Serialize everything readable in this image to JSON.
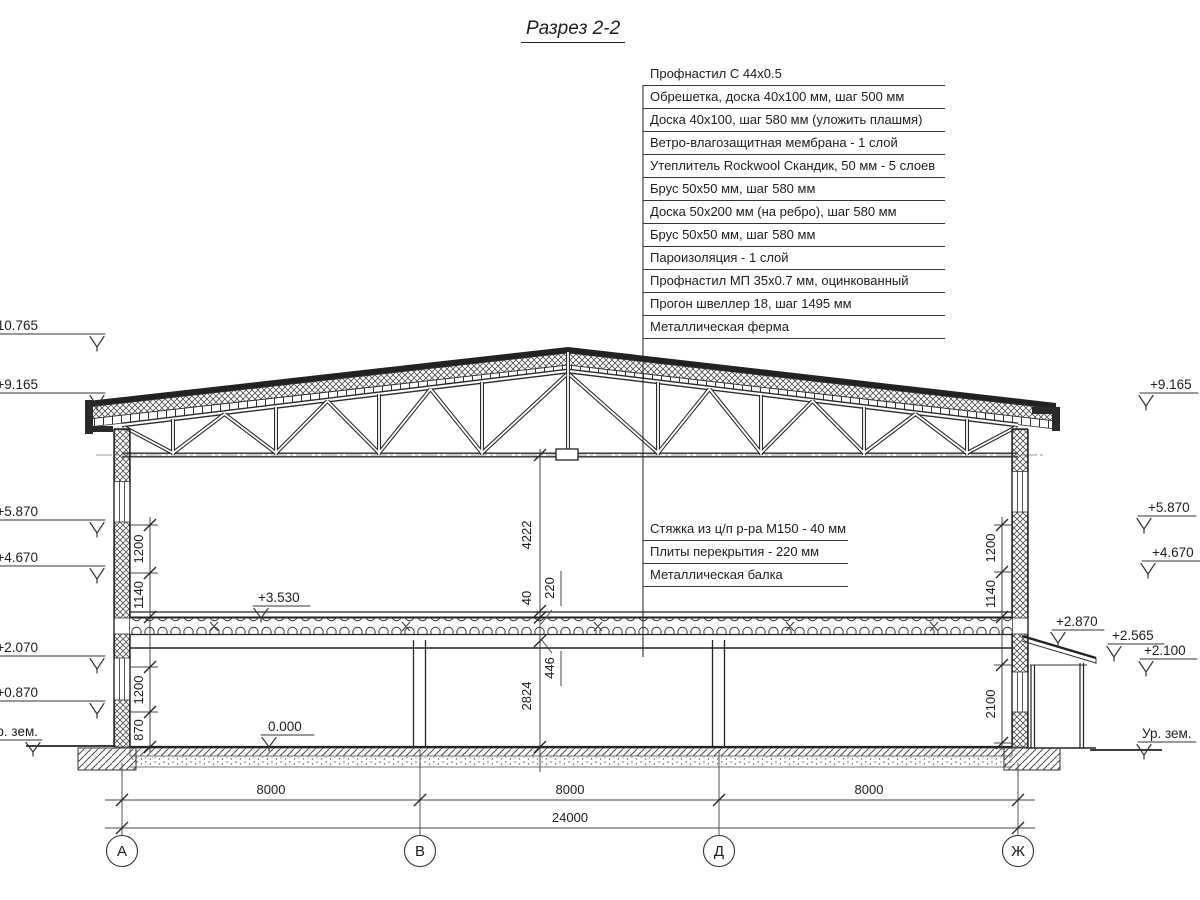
{
  "title": "Разрез 2-2",
  "roof_callouts": {
    "items": [
      "Профнастил С 44х0.5",
      "Обрешетка, доска 40х100 мм, шаг 500 мм",
      "Доска 40х100, шаг 580 мм (уложить плашмя)",
      "Ветро-влагозащитная мембрана - 1 слой",
      "Утеплитель Rockwool Скандик, 50 мм - 5 слоев",
      "Брус 50х50 мм, шаг 580 мм",
      "Доска 50х200 мм (на ребро), шаг 580 мм",
      "Брус 50х50 мм, шаг 580 мм",
      "Пароизоляция - 1 слой",
      "Профнастил МП 35х0.7 мм, оцинкованный",
      "Прогон швеллер 18, шаг 1495 мм",
      "Металлическая ферма"
    ]
  },
  "floor_callouts": {
    "items": [
      "Стяжка из ц/п р-ра М150 - 40 мм",
      "Плиты перекрытия - 220 мм",
      "Металлическая балка"
    ]
  },
  "elevations": {
    "left": [
      "+10.765",
      "+9.165",
      "+5.870",
      "+4.670",
      "+2.070",
      "+0.870",
      "Ур. зем."
    ],
    "right": [
      "+9.165",
      "+5.870",
      "+4.670",
      "+2.870",
      "+2.565",
      "+2.100",
      "Ур. зем."
    ],
    "floor_upper": "+3.530",
    "floor_ground": "0.000"
  },
  "dimensions": {
    "truss_to_floor": "4222",
    "screed": "40",
    "slab": "220",
    "beam": "446",
    "floor_height": "2824",
    "left_chain": [
      "1200",
      "1140",
      "1200",
      "870"
    ],
    "right_chain": [
      "1200",
      "1140",
      "2100"
    ],
    "bottom_spans": [
      "8000",
      "8000",
      "8000"
    ],
    "total": "24000"
  },
  "axes": [
    "А",
    "В",
    "Д",
    "Ж"
  ]
}
